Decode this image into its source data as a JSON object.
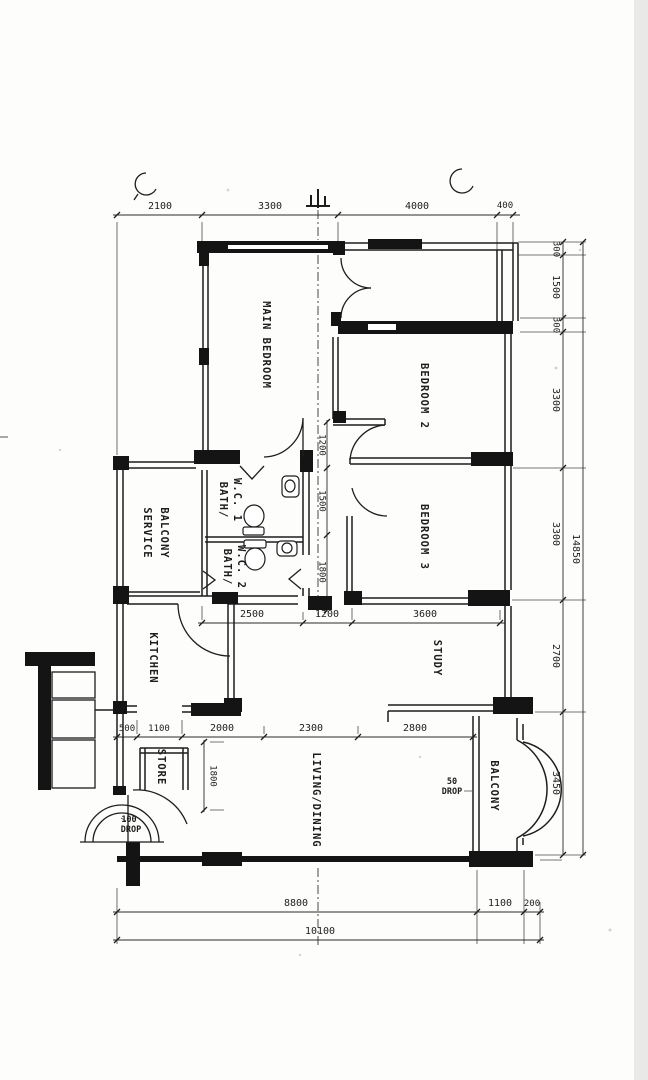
{
  "rooms": {
    "main_bedroom": "MAIN BEDROOM",
    "bedroom2": "BEDROOM 2",
    "bedroom3": "BEDROOM 3",
    "bath1_l1": "BATH/",
    "bath1_l2": "W.C. 1",
    "bath2_l1": "BATH/",
    "bath2_l2": "W.C. 2",
    "service_l1": "SERVICE",
    "service_l2": "BALCONY",
    "kitchen": "KITCHEN",
    "study": "STUDY",
    "store": "STORE",
    "living": "LIVING/DINING",
    "balcony": "BALCONY"
  },
  "dims": {
    "top": [
      "2100",
      "3300",
      "4000",
      "400"
    ],
    "right": [
      "300",
      "1500",
      "300",
      "3300",
      "3300",
      "2700",
      "3450"
    ],
    "right_total": "14850",
    "mid": [
      "2500",
      "1200",
      "3600"
    ],
    "lower": [
      "500",
      "1100",
      "2000",
      "2300",
      "2800"
    ],
    "corridor": [
      "1200",
      "1500",
      "1800"
    ],
    "store_depth": "1800",
    "bottom": [
      "8800",
      "1100",
      "200"
    ],
    "bottom_total": "10100"
  },
  "notes": {
    "entrance_drop_l1": "100",
    "entrance_drop_l2": "DROP",
    "balcony_drop_l1": "50",
    "balcony_drop_l2": "DROP"
  }
}
